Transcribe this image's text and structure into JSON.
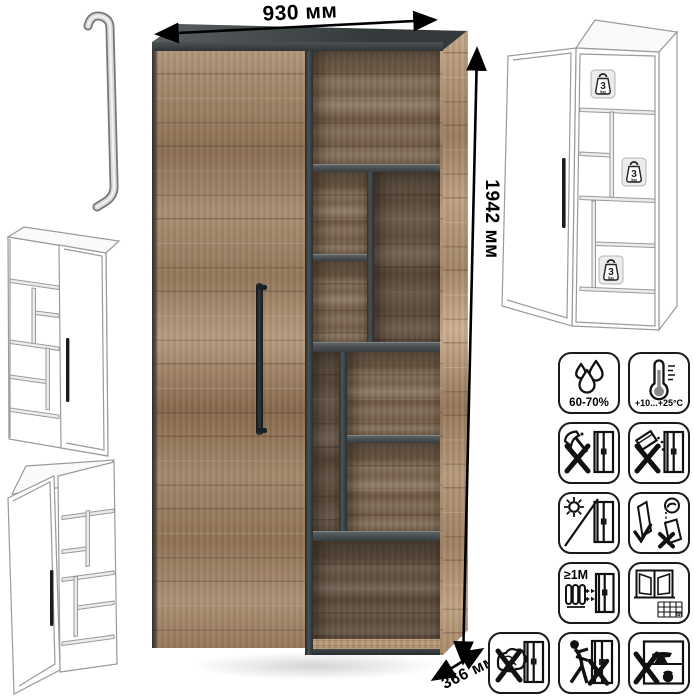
{
  "dimensions": {
    "width_label": "930 мм",
    "height_label": "1942 мм",
    "depth_label": "366 мм"
  },
  "weight_limit": {
    "value": "3",
    "unit": "kg"
  },
  "care_icons": [
    {
      "name": "humidity",
      "label": "60-70%"
    },
    {
      "name": "temperature-range",
      "label": "+10...+25°C"
    },
    {
      "name": "no-sharp-tools",
      "label": ""
    },
    {
      "name": "no-spilling-substances",
      "label": ""
    },
    {
      "name": "no-direct-sunlight",
      "label": ""
    },
    {
      "name": "carry-doors-upright",
      "label": ""
    },
    {
      "name": "keep-distance-from-heaters",
      "label": "≥1M"
    },
    {
      "name": "acclimatize-ventilate",
      "label": "21"
    },
    {
      "name": "no-wet-cloth",
      "label": ""
    },
    {
      "name": "do-not-push-assembled",
      "label": ""
    },
    {
      "name": "no-heavy-objects-inside",
      "label": ""
    }
  ],
  "colors": {
    "wood": "#a18466",
    "wood_dark": "#7c6048",
    "graphite": "#44494b",
    "line_gray": "#9a9a9a",
    "black": "#111111"
  }
}
